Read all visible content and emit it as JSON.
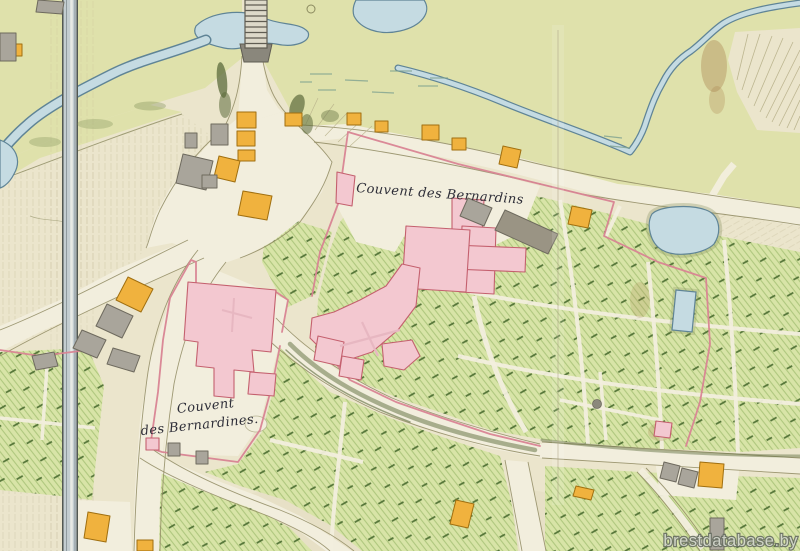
{
  "map": {
    "type": "historical-manuscript-plan",
    "labels": {
      "bernardins": "Couvent des Bernardins",
      "bernardines_line1": "Couvent",
      "bernardines_line2": "des Bernardines."
    },
    "watermark": "brestdatabase.by",
    "features": [
      "river",
      "stream",
      "lake",
      "pond-large",
      "pond-small",
      "bridge",
      "canal",
      "road-network",
      "convent-bernardins-building",
      "convent-bernardines-building",
      "garden-plots",
      "orange-houses",
      "gray-houses",
      "hachured-hill",
      "fold-line",
      "marsh-marks"
    ]
  },
  "palette": {
    "paper": "#ebe5cc",
    "meadow": "#dfe1ab",
    "garden": "#d8e4a7",
    "garden_hatch": "#afc77e",
    "garden_dash": "#3f6226",
    "water": "#c5dbe2",
    "water_edge": "#5f8496",
    "road": "#f2eedd",
    "road_edge": "#8f8a62",
    "building_pink": "#f3c8d0",
    "building_pink_edge": "#c4606e",
    "wall_pink": "#d98494",
    "building_orange": "#f0b23e",
    "building_orange_edge": "#a06f10",
    "building_gray": "#a9a59b",
    "building_gray_edge": "#6e6a5e",
    "tree_dark": "#5c6b3c",
    "hachure": "#c2b996",
    "canal": "#c3cdd0",
    "label_ink": "#2e2e38",
    "watermark_fill": "#d2d6cc",
    "watermark_edge": "#676d62"
  }
}
